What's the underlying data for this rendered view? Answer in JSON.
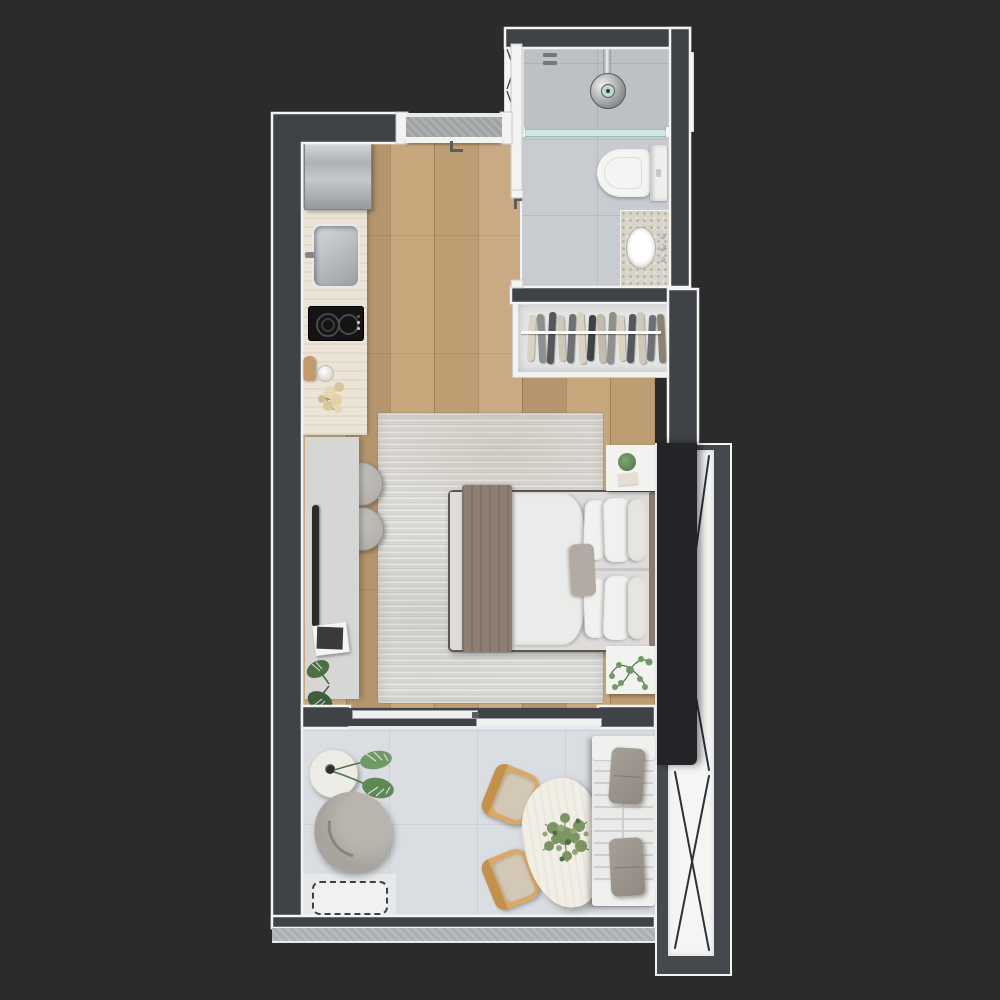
{
  "scene": {
    "title": "Studio apartment floor plan - top-down 3D render",
    "type": "floor-plan-render"
  },
  "palette": {
    "background": "#2b2b2c",
    "wall_dark": "#3f4247",
    "wall_outline": "#f4f4f3",
    "partition_white": "#f2f3f2",
    "wood_floor": "#c3a075",
    "bath_tile": "#c8ccd1",
    "bath_tile_line": "#b7bcc1",
    "living_tile": "#dadde1",
    "living_tile_line": "#ced1d5",
    "living_patch": "#e6e8ea",
    "concrete": "#a7aaac",
    "sill_concrete": "#b4b7b9",
    "counter_travertine": "#ece5d7",
    "terrazzo": "#d9d4ca",
    "cooktop_black": "#141414",
    "rug": "#d9d8d4",
    "mattress_white": "#ebebe9",
    "sheet_gray": "#dddcda",
    "throw_taupe": "#8e7f74",
    "pillow_white": "#f1f1ef",
    "cushion_gray": "#b2aba3",
    "headboard_taupe": "#8a7c71",
    "nightstand_white": "#f2f2f0",
    "closet_bg": "#e4e5e5",
    "curtain_dark": "#222427",
    "glazing_white": "#f4f5f4",
    "glazing_line": "#303336",
    "window_frame_gray": "#45484c",
    "sofa_white": "#eaeae8",
    "sofa_slat_line": "#cfcfcd",
    "sofa_pillow_gray": "#9c968e",
    "armchair_gray": "#a8a49d",
    "armchair_inner": "#b9b5ae",
    "stool_gray": "#b5b1ac",
    "desk_gray": "#d6d7d5",
    "desk_groove": "#2b2b2b",
    "table_cream": "#f1eee5",
    "chair_wood": "#daa968",
    "chair_cushion": "#d3c7b5",
    "plant_green": "#6f9a66",
    "plant_green_dark": "#4e6f45",
    "glass_teal": "#cfe9e0",
    "glass_teal_edge": "#9cc2b6",
    "porcelain_white": "#f4f5f3",
    "dashed_line": "#3f3f3f"
  },
  "closet": {
    "garments": [
      "#d9d2c1",
      "#8f8f8d",
      "#55575a",
      "#cfc8b8",
      "#6e7073",
      "#d9d2c1",
      "#3f4144",
      "#c4bcab",
      "#8f8f8d",
      "#d9d2c1",
      "#55575a",
      "#cfc8b8",
      "#6e7073",
      "#8a8273"
    ]
  },
  "objects": [
    {
      "id": "entry-door",
      "label": "entry door with handle"
    },
    {
      "id": "refrigerator",
      "label": "stainless refrigerator"
    },
    {
      "id": "kitchen-counter",
      "label": "travertine kitchen counter"
    },
    {
      "id": "kitchen-sink",
      "label": "stainless sink"
    },
    {
      "id": "cooktop",
      "label": "two-burner cooktop"
    },
    {
      "id": "duct-shaft",
      "label": "service shaft"
    },
    {
      "id": "shower",
      "label": "shower with rain head and glass partition"
    },
    {
      "id": "toilet",
      "label": "toilet"
    },
    {
      "id": "vanity",
      "label": "terrazzo vanity with basin"
    },
    {
      "id": "bathroom-window",
      "label": "bathroom window"
    },
    {
      "id": "wardrobe",
      "label": "open wardrobe with hanging clothes"
    },
    {
      "id": "double-bed",
      "label": "double bed with taupe throw and pillows"
    },
    {
      "id": "nightstand",
      "label": "nightstands with plants"
    },
    {
      "id": "area-rug",
      "label": "gray area rug"
    },
    {
      "id": "desk",
      "label": "wall desk with stools, books and plant"
    },
    {
      "id": "window-wall",
      "label": "floor-to-ceiling window with curtain"
    },
    {
      "id": "sliding-door",
      "label": "sliding balcony door"
    },
    {
      "id": "armchair",
      "label": "swivel armchair"
    },
    {
      "id": "side-table",
      "label": "round side table with monstera"
    },
    {
      "id": "dining-table",
      "label": "organic-shaped dining table with plant"
    },
    {
      "id": "dining-chairs",
      "label": "two wooden dining chairs"
    },
    {
      "id": "sofa",
      "label": "slatted sofa with gray cushions"
    },
    {
      "id": "ac-outline",
      "label": "dashed equipment outline"
    },
    {
      "id": "balcony-sill",
      "label": "concrete balcony sill"
    }
  ]
}
